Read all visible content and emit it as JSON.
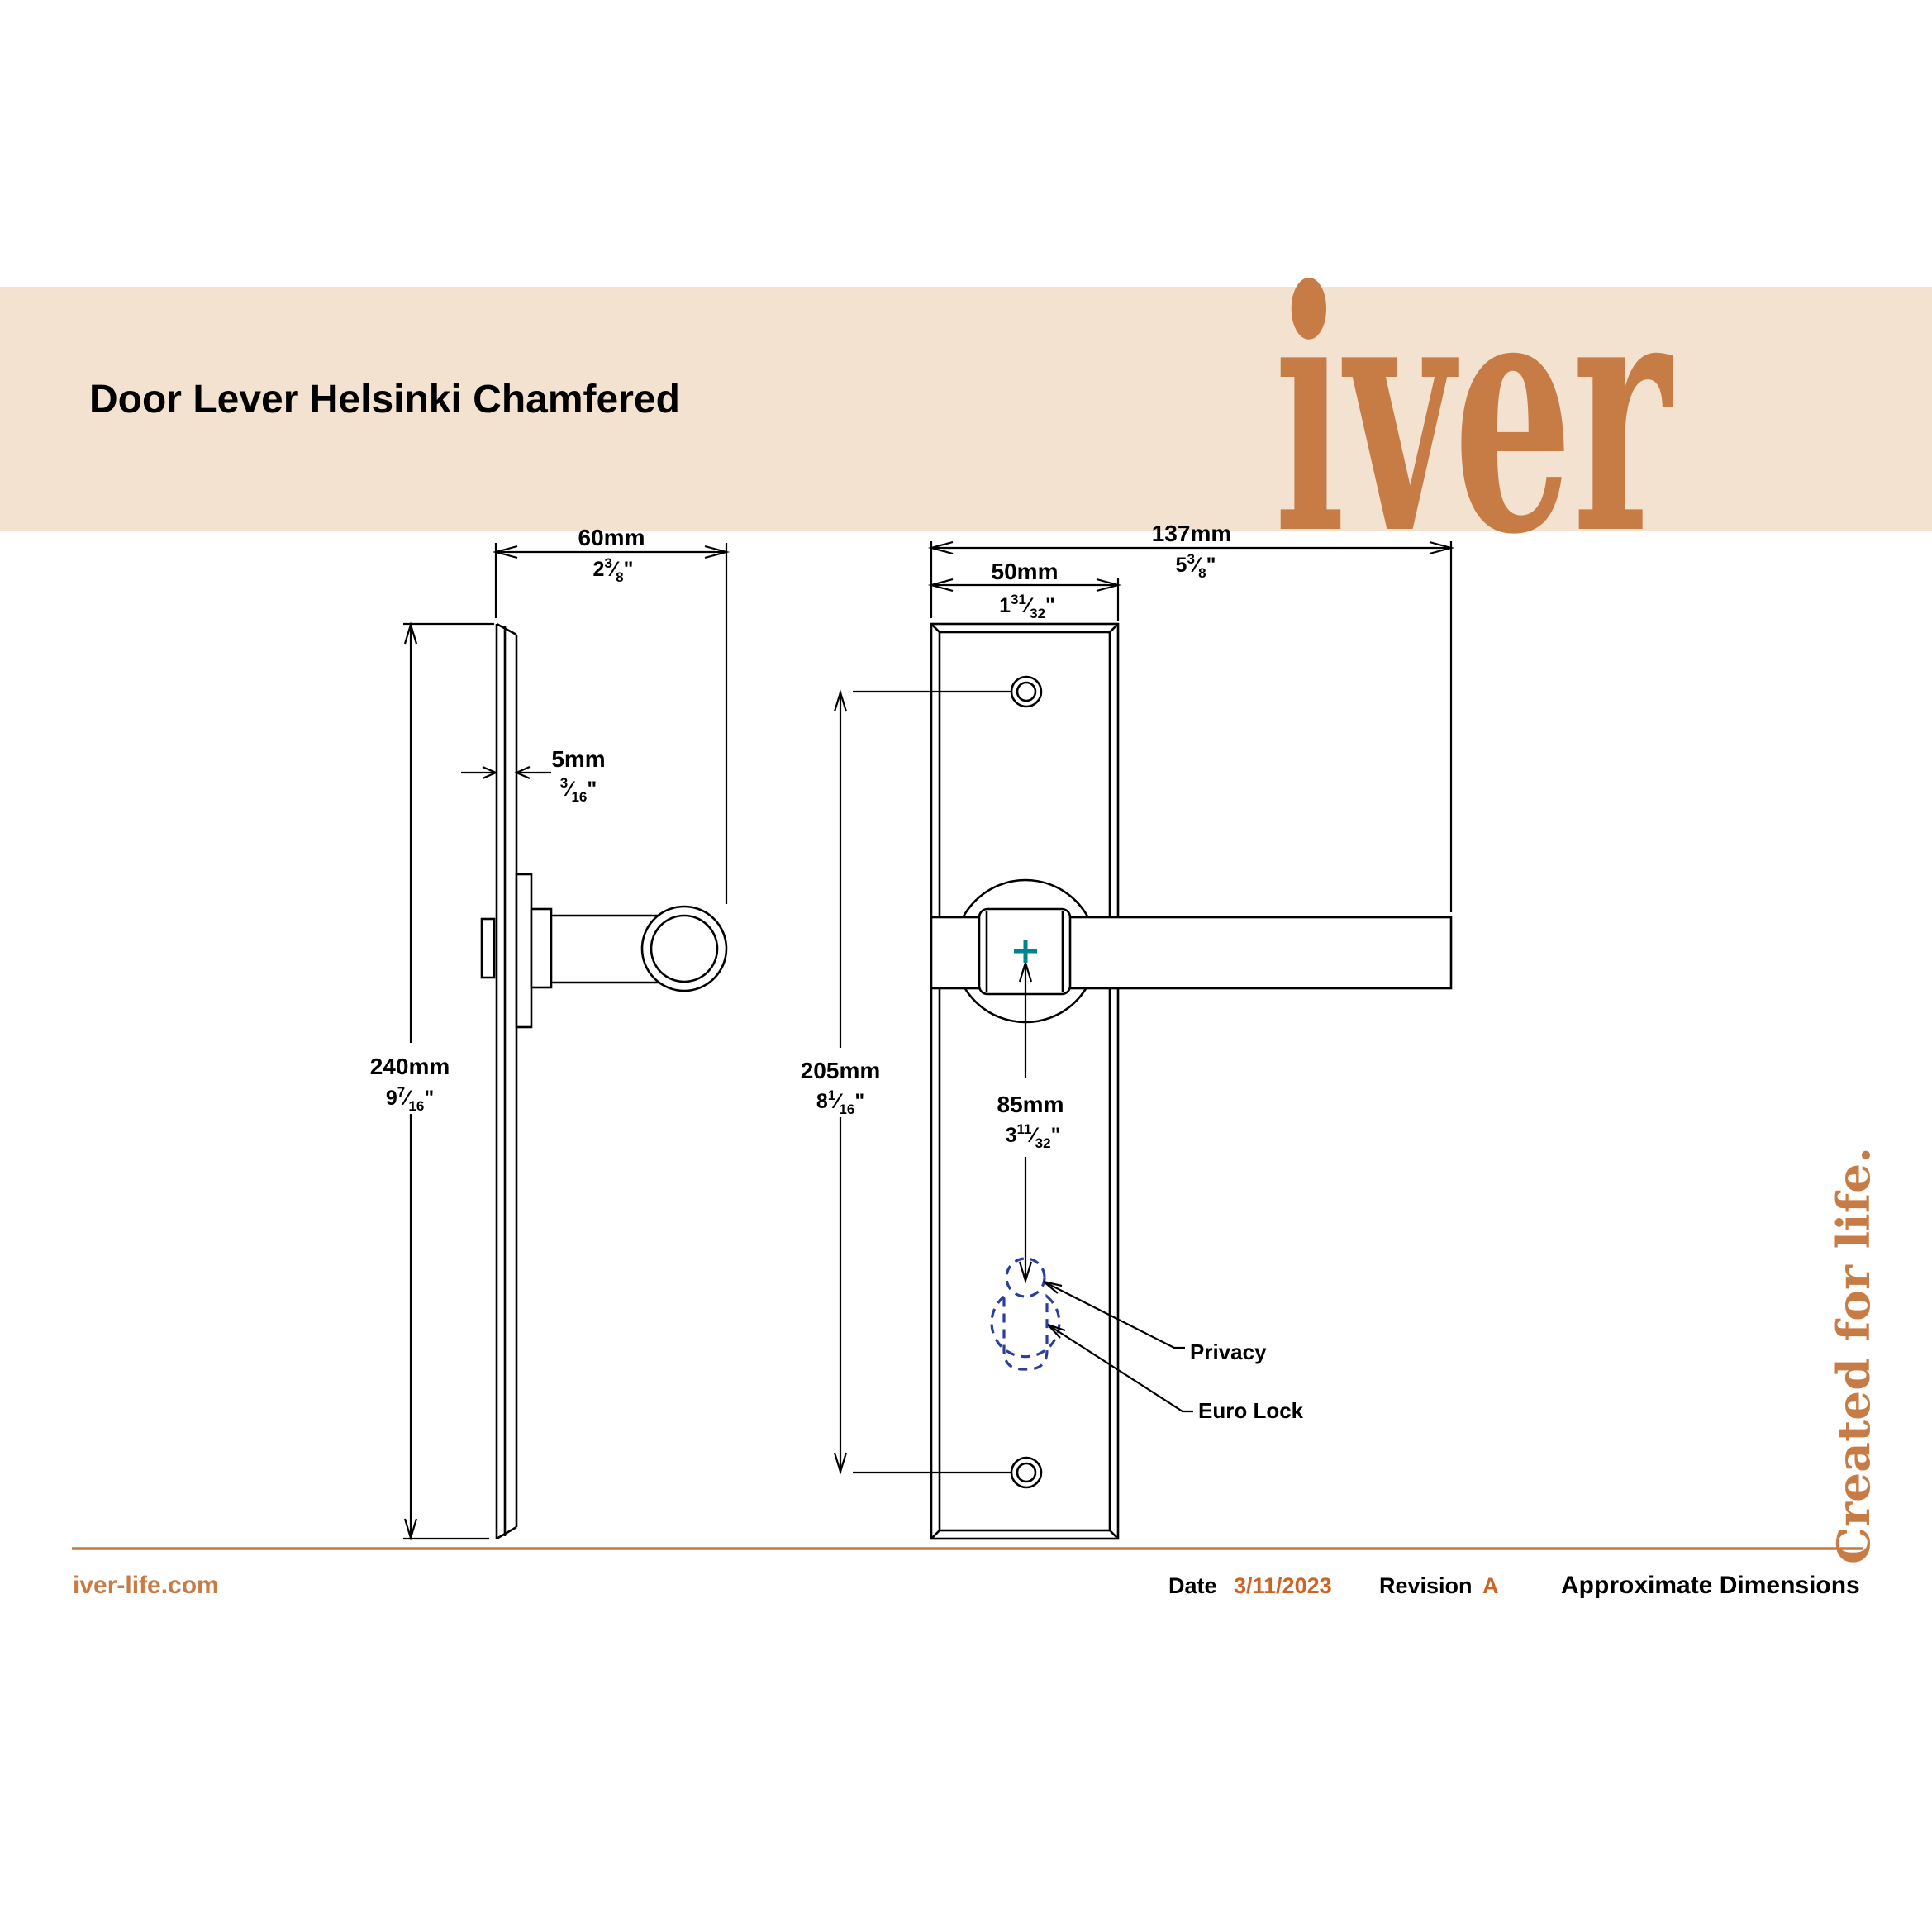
{
  "header": {
    "title": "Door Lever Helsinki Chamfered",
    "logo": "iver"
  },
  "marks": {
    "frac": "⁄",
    "inch": "\""
  },
  "dims": {
    "w60": {
      "mm": "60mm",
      "frw": "2",
      "frn": "3",
      "frd": "8"
    },
    "t5": {
      "mm": "5mm",
      "frw": "",
      "frn": "3",
      "frd": "16"
    },
    "h240": {
      "mm": "240mm",
      "frw": "9",
      "frn": "7",
      "frd": "16"
    },
    "w137": {
      "mm": "137mm",
      "frw": "5",
      "frn": "3",
      "frd": "8"
    },
    "w50": {
      "mm": "50mm",
      "frw": "1",
      "frn": "31",
      "frd": "32"
    },
    "c205": {
      "mm": "205mm",
      "frw": "8",
      "frn": "1",
      "frd": "16"
    },
    "p85": {
      "mm": "85mm",
      "frw": "3",
      "frn": "11",
      "frd": "32"
    }
  },
  "labels": {
    "privacy": "Privacy",
    "euro_lock": "Euro Lock"
  },
  "footer": {
    "website": "iver-life.com",
    "date_label": "Date",
    "date_value": "3/11/2023",
    "revision_label": "Revision",
    "revision_value": "A",
    "note": "Approximate Dimensions",
    "tagline": "Created for life."
  },
  "colors": {
    "band": "#f4e2d1",
    "accent": "#cc6426",
    "logo_orange": "#c87c45",
    "rule": "#c67a3e",
    "dash_blue": "#2b3e9b",
    "cross_teal": "#00838c",
    "ink": "#000000"
  }
}
